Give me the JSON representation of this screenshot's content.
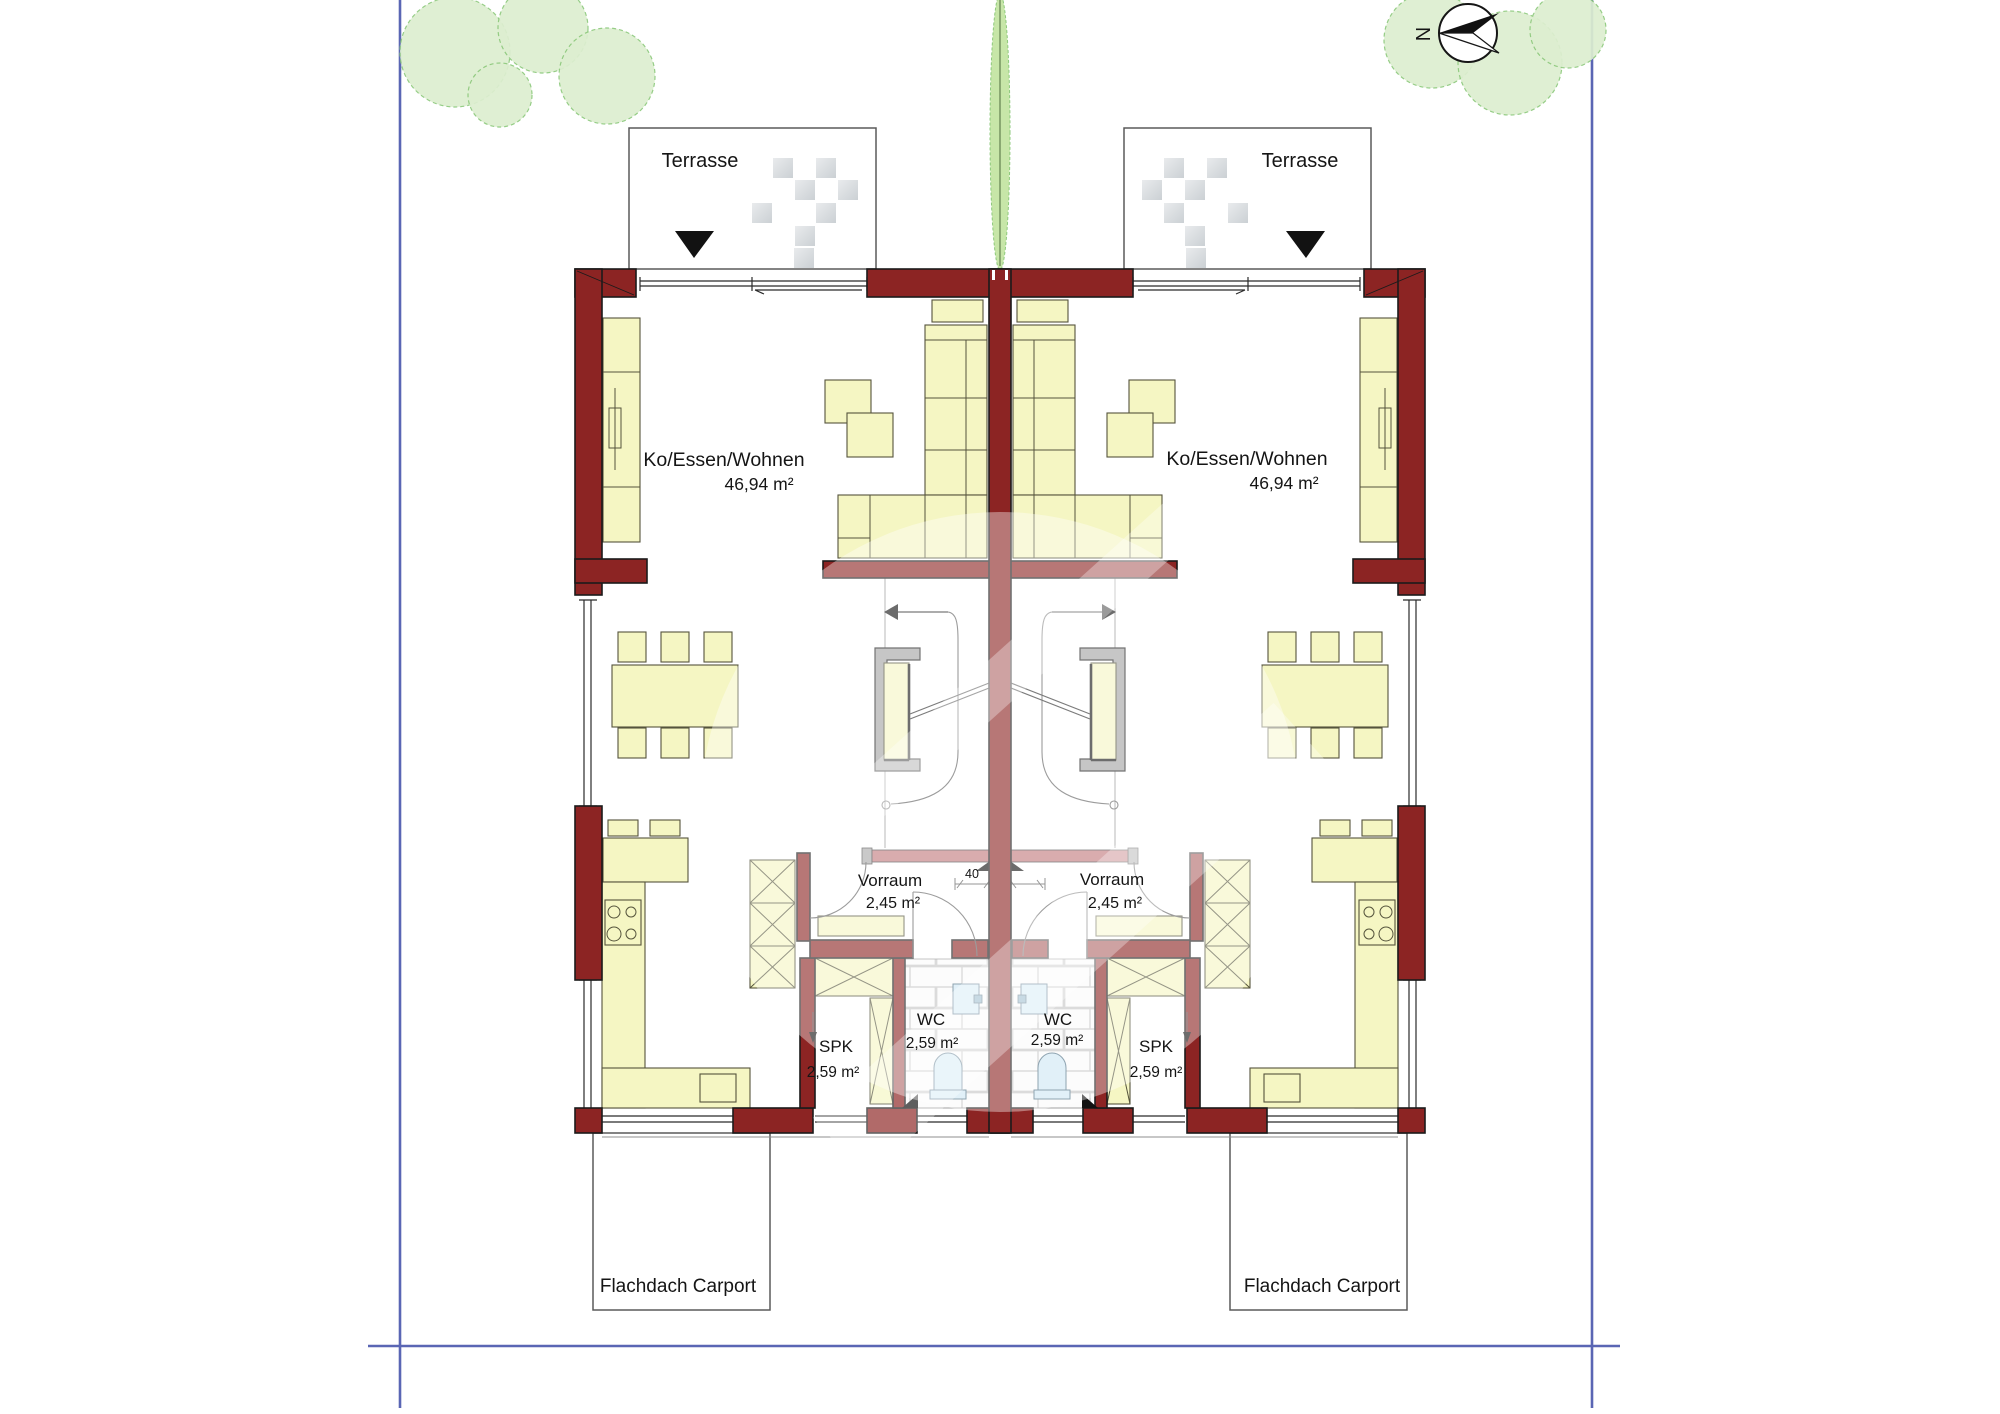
{
  "plan": {
    "compass": {
      "north_label": "N"
    },
    "site": {
      "terrace_left_label": "Terrasse",
      "terrace_right_label": "Terrasse",
      "carport_left_label": "Flachdach Carport",
      "carport_right_label": "Flachdach Carport"
    },
    "units": {
      "left": {
        "living": {
          "name": "Ko/Essen/Wohnen",
          "area": "46,94 m²"
        },
        "vorraum": {
          "name": "Vorraum",
          "area": "2,45 m²"
        },
        "wc": {
          "name": "WC",
          "area": "2,59 m²"
        },
        "spk": {
          "name": "SPK",
          "area": "2,59 m²"
        }
      },
      "right": {
        "living": {
          "name": "Ko/Essen/Wohnen",
          "area": "46,94 m²"
        },
        "vorraum": {
          "name": "Vorraum",
          "area": "2,45 m²"
        },
        "wc": {
          "name": "WC",
          "area": "2,59 m²"
        },
        "spk": {
          "name": "SPK",
          "area": "2,59 m²"
        }
      }
    },
    "dimensions": {
      "party_wall": "40"
    },
    "colors": {
      "wall": "#8c2423",
      "furniture": "#f5f6c3",
      "fixture": "#cfe7f4",
      "tree_fill": "#ddeed0",
      "tree_stroke": "#8dc97c",
      "hedge_fill": "#c7e6a8",
      "border_line": "#5a66b4",
      "sill": "#c2797d"
    }
  }
}
